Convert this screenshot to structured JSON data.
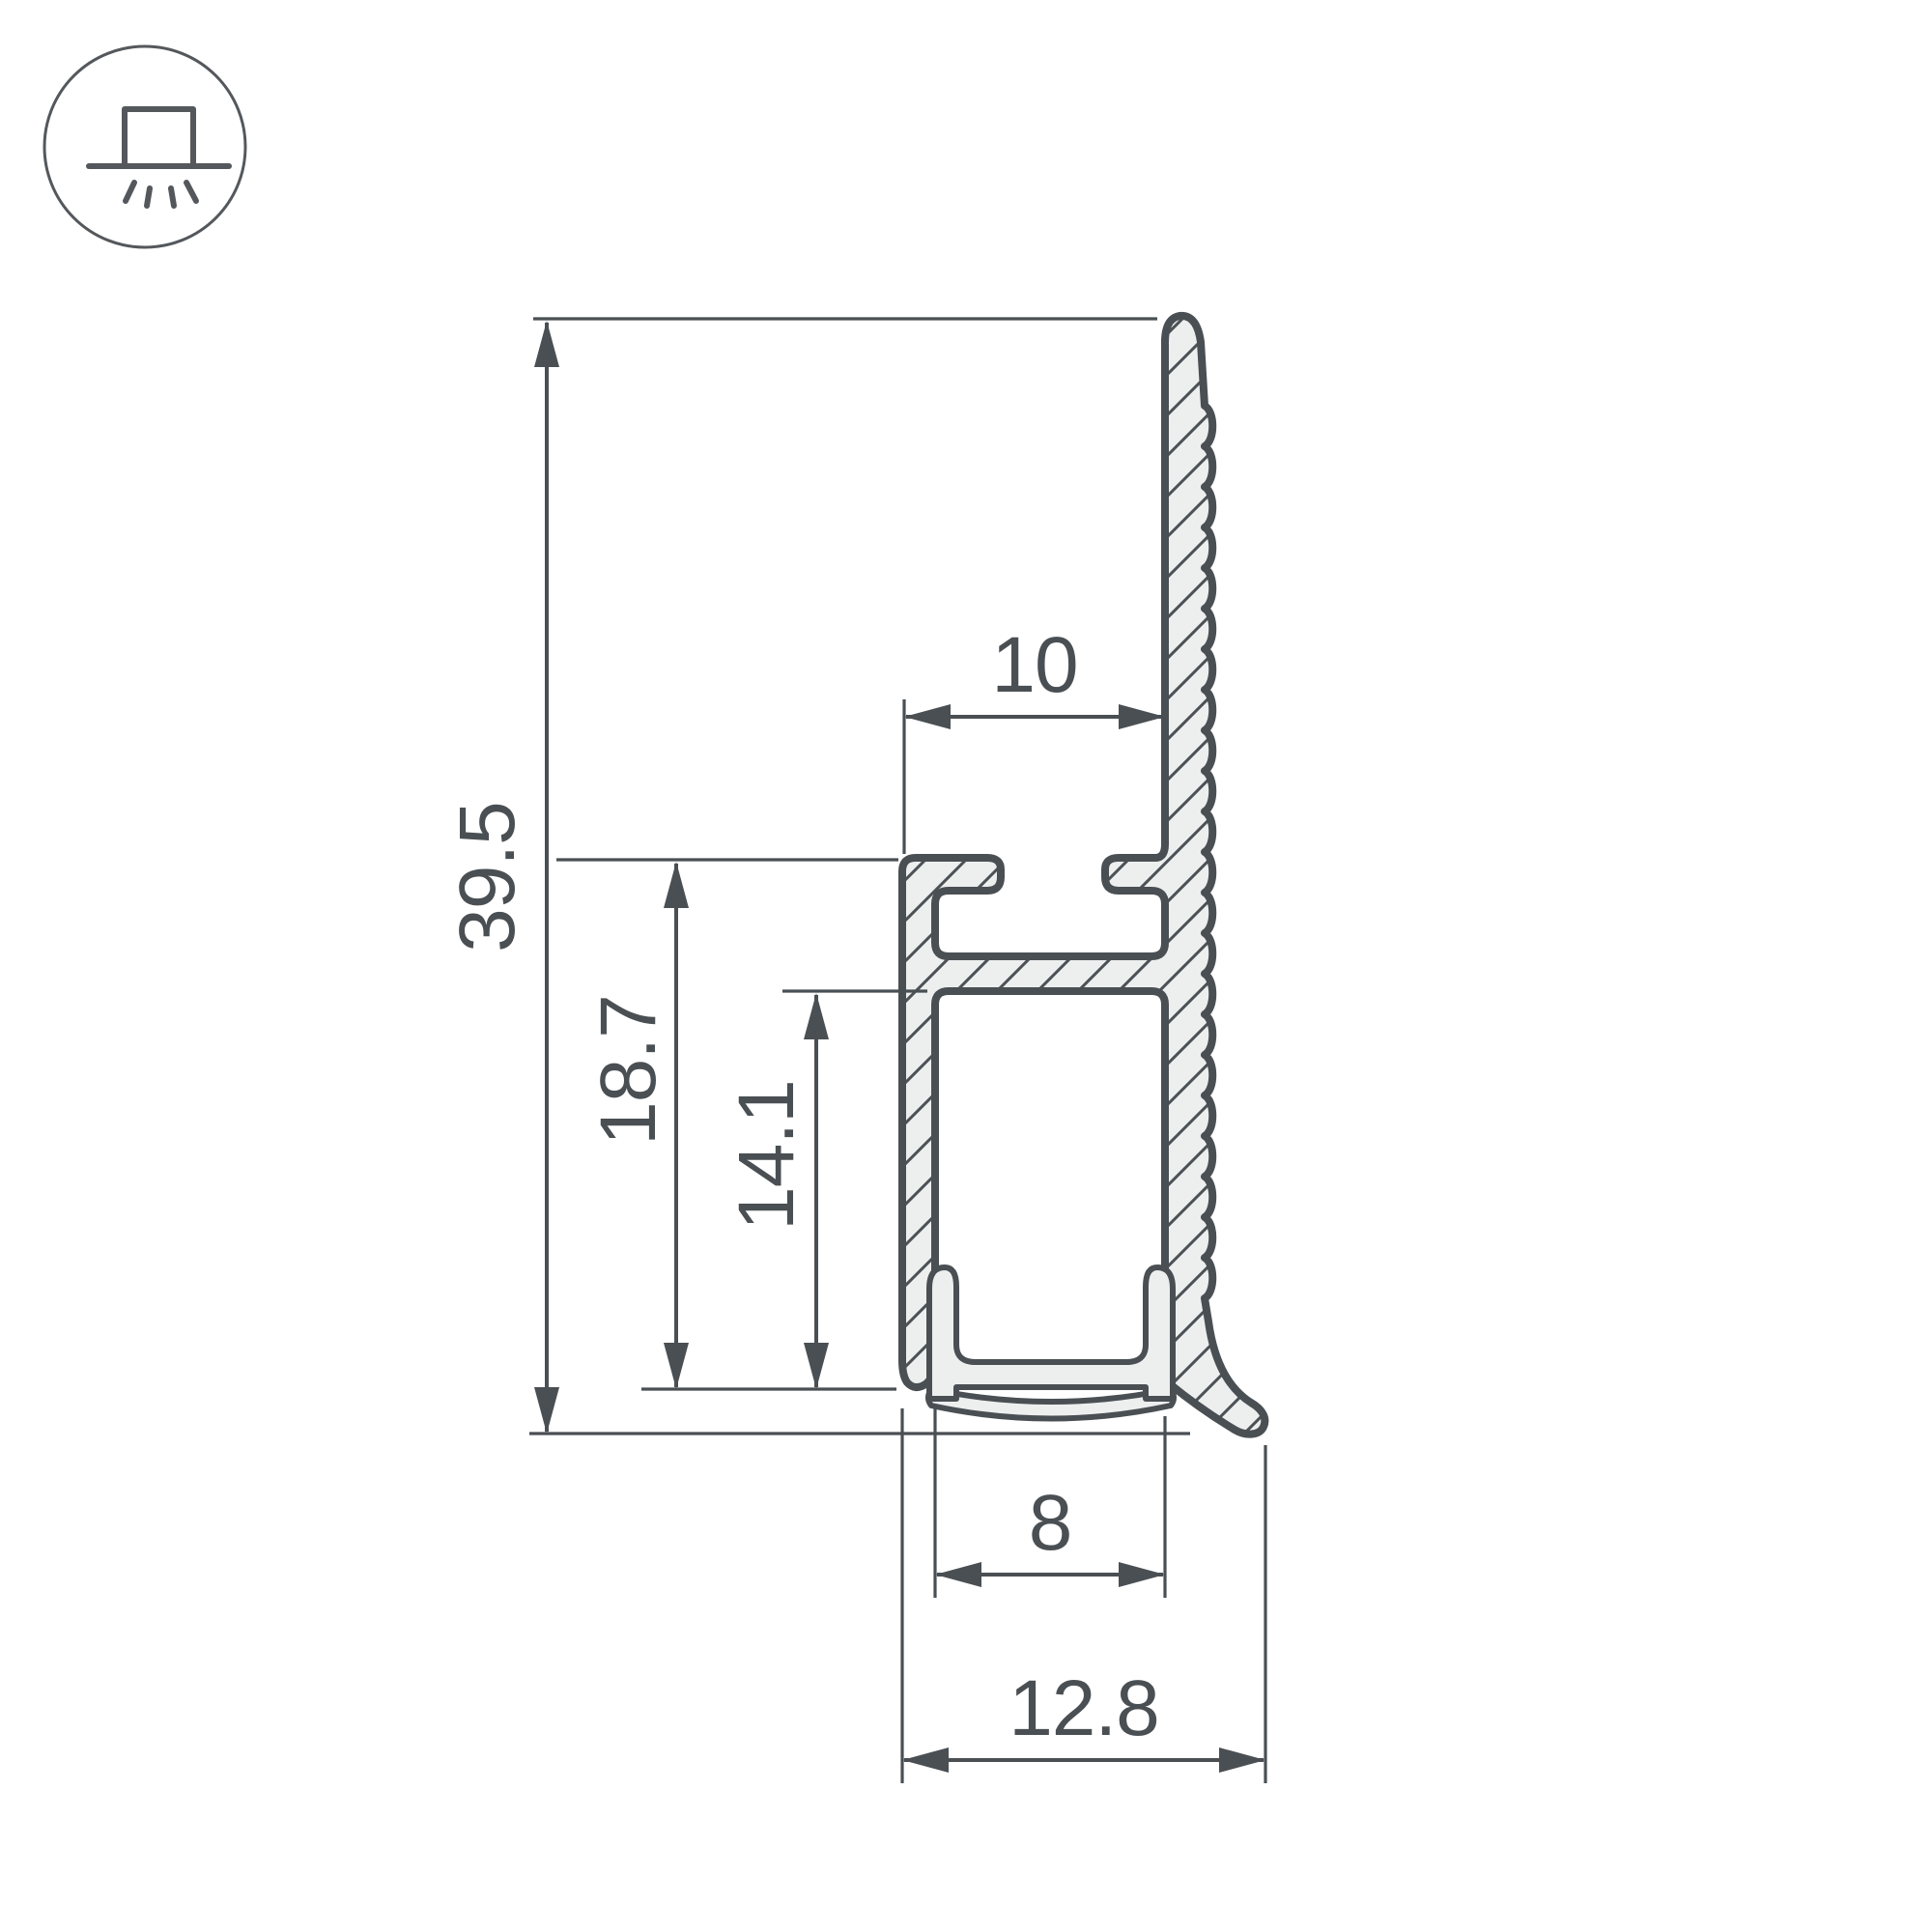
{
  "drawing": {
    "title": "LED profile cross-section dimensional drawing",
    "units": "mm",
    "dimensions": {
      "total_height": {
        "value": "39.5",
        "orientation": "vertical",
        "measures": "overall profile height"
      },
      "body_height": {
        "value": "18.7",
        "orientation": "vertical",
        "measures": "channel body height"
      },
      "inner_height": {
        "value": "14.1",
        "orientation": "vertical",
        "measures": "inner cavity height"
      },
      "groove_width": {
        "value": "10",
        "orientation": "horizontal",
        "measures": "top mounting groove width"
      },
      "channel_width": {
        "value": "8",
        "orientation": "horizontal",
        "measures": "inner LED channel width"
      },
      "total_width": {
        "value": "12.8",
        "orientation": "horizontal",
        "measures": "overall profile width"
      }
    },
    "icon": {
      "name": "surface-mounted-luminaire",
      "description": "circle with box on a line emitting light rays downward"
    },
    "colors": {
      "line": "#4a4f53",
      "profile_fill": "#edefef",
      "hatch": "#4b5155",
      "icon_line": "#54585c",
      "background": "#ffffff"
    }
  }
}
